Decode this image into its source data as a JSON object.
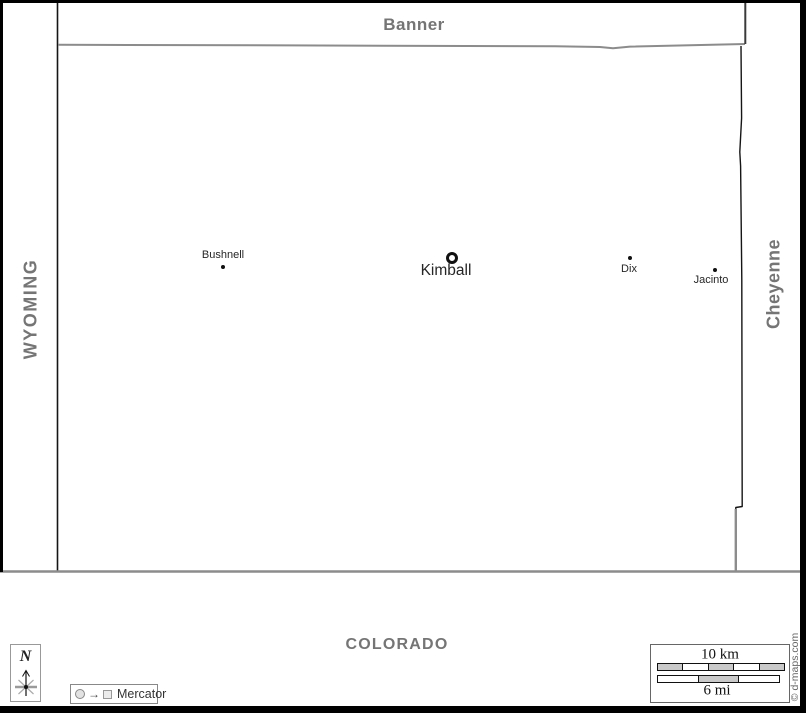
{
  "neighbors": {
    "north": "Banner",
    "west": "WYOMING",
    "east": "Cheyenne",
    "south": "COLORADO"
  },
  "towns": [
    {
      "name": "Bushnell",
      "marker": "dot"
    },
    {
      "name": "Kimball",
      "marker": "ring"
    },
    {
      "name": "Dix",
      "marker": "dot"
    },
    {
      "name": "Jacinto",
      "marker": "dot"
    }
  ],
  "compass": {
    "label": "N"
  },
  "projection": {
    "label": "Mercator",
    "arrow": "→"
  },
  "scale": {
    "km_label": "10 km",
    "mi_label": "6 mi",
    "km_segments": 5,
    "mi_segments": 3
  },
  "credit": "© d-maps.com",
  "colors": {
    "boundary_black": "#151515",
    "boundary_gray": "#8c8c8c",
    "neighbor_label": "#757575",
    "town_label": "#262626",
    "scale_fill": "#c9c9c9"
  }
}
